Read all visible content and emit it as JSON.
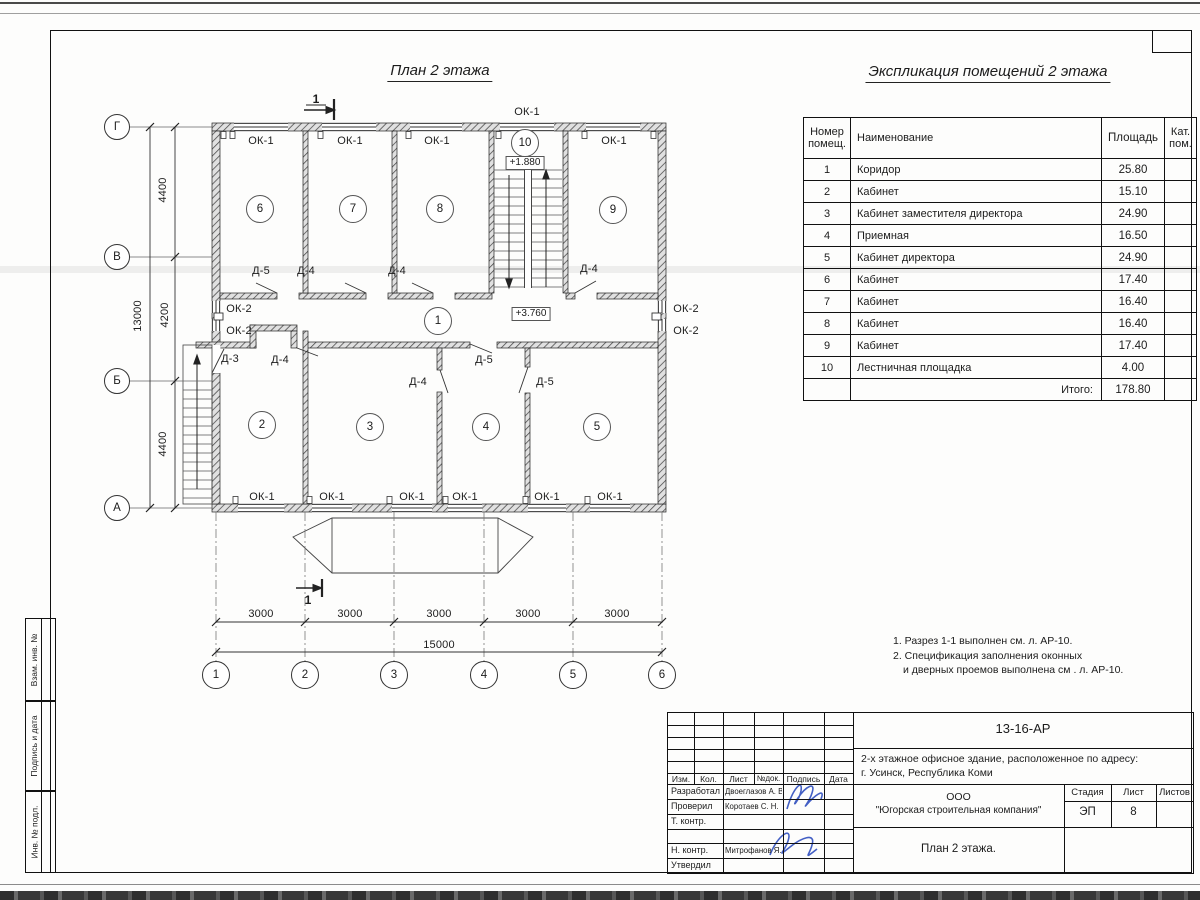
{
  "titles": {
    "plan": "План 2 этажа",
    "explication": "Экспликация помещений 2 этажа"
  },
  "explication_table": {
    "headers": {
      "number": "Номер помещ.",
      "name": "Наименование",
      "area": "Площадь",
      "cat": "Кат. пом."
    },
    "rows": [
      {
        "n": "1",
        "name": "Коридор",
        "area": "25.80"
      },
      {
        "n": "2",
        "name": "Кабинет",
        "area": "15.10"
      },
      {
        "n": "3",
        "name": "Кабинет заместителя директора",
        "area": "24.90"
      },
      {
        "n": "4",
        "name": "Приемная",
        "area": "16.50"
      },
      {
        "n": "5",
        "name": "Кабинет директора",
        "area": "24.90"
      },
      {
        "n": "6",
        "name": "Кабинет",
        "area": "17.40"
      },
      {
        "n": "7",
        "name": "Кабинет",
        "area": "16.40"
      },
      {
        "n": "8",
        "name": "Кабинет",
        "area": "16.40"
      },
      {
        "n": "9",
        "name": "Кабинет",
        "area": "17.40"
      },
      {
        "n": "10",
        "name": "Лестничная площадка",
        "area": "4.00"
      }
    ],
    "total_label": "Итого:",
    "total_value": "178.80"
  },
  "notes": {
    "line1": "1. Разрез 1-1 выполнен см. л. АР-10.",
    "line2": "2. Спецификация заполнения оконных",
    "line3": "и дверных проемов выполнена см . л. АР-10."
  },
  "plan": {
    "labels": [
      {
        "t": "ОК-1",
        "x": 261,
        "y": 141,
        "n": "window-label"
      },
      {
        "t": "ОК-1",
        "x": 350,
        "y": 141,
        "n": "window-label"
      },
      {
        "t": "ОК-1",
        "x": 437,
        "y": 141,
        "n": "window-label"
      },
      {
        "t": "ОК-1",
        "x": 614,
        "y": 141,
        "n": "window-label"
      },
      {
        "t": "ОК-1",
        "x": 527,
        "y": 112,
        "n": "window-label"
      },
      {
        "t": "ОК-1",
        "x": 262,
        "y": 497,
        "n": "window-label"
      },
      {
        "t": "ОК-1",
        "x": 332,
        "y": 497,
        "n": "window-label"
      },
      {
        "t": "ОК-1",
        "x": 412,
        "y": 497,
        "n": "window-label"
      },
      {
        "t": "ОК-1",
        "x": 465,
        "y": 497,
        "n": "window-label"
      },
      {
        "t": "ОК-1",
        "x": 547,
        "y": 497,
        "n": "window-label"
      },
      {
        "t": "ОК-1",
        "x": 610,
        "y": 497,
        "n": "window-label"
      },
      {
        "t": "ОК-2",
        "x": 239,
        "y": 309,
        "n": "window-label"
      },
      {
        "t": "ОК-2",
        "x": 239,
        "y": 331,
        "n": "window-label"
      },
      {
        "t": "ОК-2",
        "x": 686,
        "y": 309,
        "n": "window-label"
      },
      {
        "t": "ОК-2",
        "x": 686,
        "y": 331,
        "n": "window-label"
      },
      {
        "t": "Д-5",
        "x": 261,
        "y": 271,
        "n": "door-label"
      },
      {
        "t": "Д-4",
        "x": 306,
        "y": 271,
        "n": "door-label"
      },
      {
        "t": "Д-4",
        "x": 397,
        "y": 271,
        "n": "door-label"
      },
      {
        "t": "Д-4",
        "x": 589,
        "y": 269,
        "n": "door-label"
      },
      {
        "t": "Д-3",
        "x": 230,
        "y": 359,
        "n": "door-label"
      },
      {
        "t": "Д-4",
        "x": 280,
        "y": 360,
        "n": "door-label"
      },
      {
        "t": "Д-4",
        "x": 418,
        "y": 382,
        "n": "door-label"
      },
      {
        "t": "Д-5",
        "x": 484,
        "y": 360,
        "n": "door-label"
      },
      {
        "t": "Д-5",
        "x": 545,
        "y": 382,
        "n": "door-label"
      },
      {
        "t": "3000",
        "x": 261,
        "y": 614,
        "n": "dim-label"
      },
      {
        "t": "3000",
        "x": 350,
        "y": 614,
        "n": "dim-label"
      },
      {
        "t": "3000",
        "x": 439,
        "y": 614,
        "n": "dim-label"
      },
      {
        "t": "3000",
        "x": 528,
        "y": 614,
        "n": "dim-label"
      },
      {
        "t": "3000",
        "x": 617,
        "y": 614,
        "n": "dim-label"
      },
      {
        "t": "15000",
        "x": 439,
        "y": 645,
        "n": "dim-label"
      },
      {
        "t": "1",
        "x": 316,
        "y": 99,
        "n": "section-mark-label"
      },
      {
        "t": "1",
        "x": 308,
        "y": 600,
        "n": "section-mark-label"
      }
    ],
    "vlabels": [
      {
        "t": "4400",
        "x": 163,
        "y": 190,
        "n": "dim-label"
      },
      {
        "t": "4200",
        "x": 165,
        "y": 315,
        "n": "dim-label"
      },
      {
        "t": "4400",
        "x": 163,
        "y": 444,
        "n": "dim-label"
      },
      {
        "t": "13000",
        "x": 138,
        "y": 316,
        "n": "dim-label"
      }
    ],
    "axis_bubbles": [
      {
        "label": "Г",
        "x": 117,
        "y": 127,
        "d": 24
      },
      {
        "label": "В",
        "x": 117,
        "y": 257,
        "d": 24
      },
      {
        "label": "Б",
        "x": 117,
        "y": 381,
        "d": 24
      },
      {
        "label": "А",
        "x": 117,
        "y": 508,
        "d": 24
      },
      {
        "label": "1",
        "x": 216,
        "y": 675,
        "d": 26
      },
      {
        "label": "2",
        "x": 305,
        "y": 675,
        "d": 26
      },
      {
        "label": "3",
        "x": 394,
        "y": 675,
        "d": 26
      },
      {
        "label": "4",
        "x": 484,
        "y": 675,
        "d": 26
      },
      {
        "label": "5",
        "x": 573,
        "y": 675,
        "d": 26
      },
      {
        "label": "6",
        "x": 662,
        "y": 675,
        "d": 26
      }
    ],
    "room_bubbles": [
      {
        "label": "1",
        "x": 438,
        "y": 321
      },
      {
        "label": "2",
        "x": 262,
        "y": 425
      },
      {
        "label": "3",
        "x": 370,
        "y": 427
      },
      {
        "label": "4",
        "x": 486,
        "y": 427
      },
      {
        "label": "5",
        "x": 597,
        "y": 427
      },
      {
        "label": "6",
        "x": 260,
        "y": 209
      },
      {
        "label": "7",
        "x": 353,
        "y": 209
      },
      {
        "label": "8",
        "x": 440,
        "y": 209
      },
      {
        "label": "9",
        "x": 613,
        "y": 210
      },
      {
        "label": "10",
        "x": 525,
        "y": 143
      }
    ],
    "levels": [
      {
        "text": "+1.880",
        "x": 525,
        "y": 163
      },
      {
        "text": "+3.760",
        "x": 531,
        "y": 314
      }
    ]
  },
  "titleblock": {
    "doc_number": "13-16-АР",
    "project_line1": "2-х этажное офисное здание, расположенное по адресу:",
    "project_line2": "г. Усинск, Республика Коми",
    "company_line1": "ООО",
    "company_line2": "\"Югорская строительная компания\"",
    "sheet_title": "План 2 этажа.",
    "stage_label": "Стадия",
    "sheet_label": "Лист",
    "sheets_label": "Листов",
    "stage": "ЭП",
    "sheet": "8",
    "cols": {
      "izm": "Изм.",
      "kol": "Кол.",
      "list": "Лист",
      "ndoc": "№док.",
      "sign": "Подпись",
      "date": "Дата"
    },
    "roles": [
      {
        "label": "Разработал",
        "name": "Двоеглазов А. В."
      },
      {
        "label": "Проверил",
        "name": "Коротаев С. Н."
      },
      {
        "label": "Т. контр.",
        "name": ""
      },
      {
        "label": "",
        "name": ""
      },
      {
        "label": "Н. контр.",
        "name": "Митрофанов Я. А."
      },
      {
        "label": "Утвердил",
        "name": ""
      }
    ]
  },
  "sidebar": {
    "items": [
      {
        "label": "Взам. инв. №"
      },
      {
        "label": "Подпись и дата"
      },
      {
        "label": "Инв. № подл."
      }
    ]
  }
}
